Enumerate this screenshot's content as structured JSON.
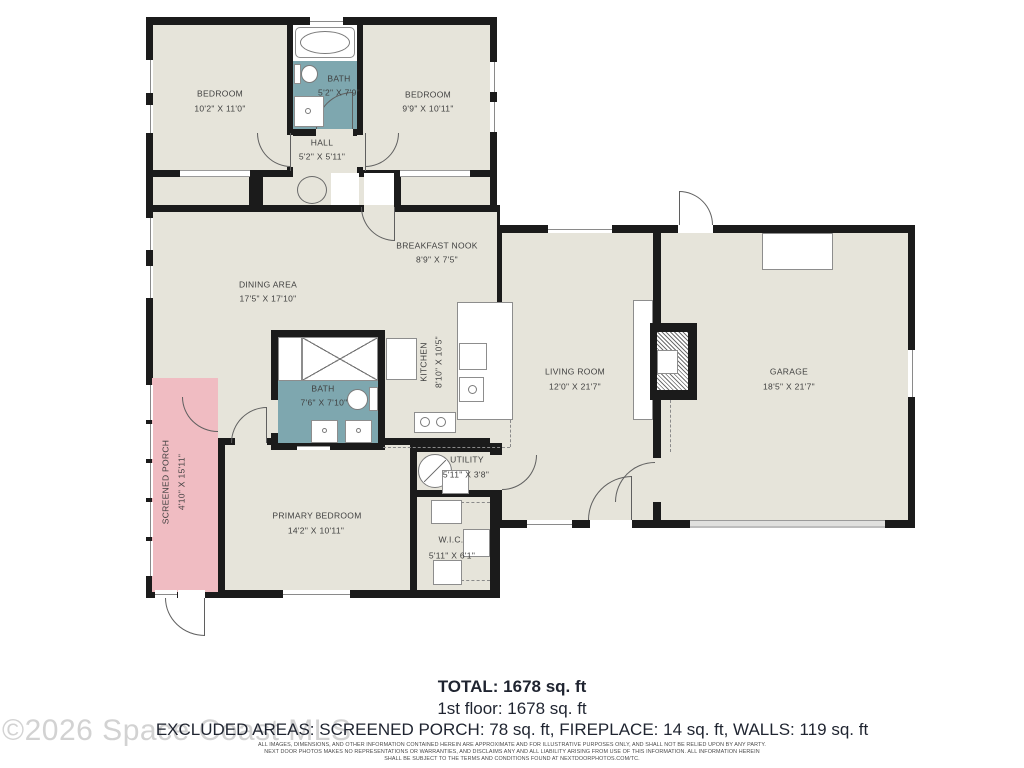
{
  "floorplan": {
    "rooms": [
      {
        "name": "BEDROOM",
        "dims": "10'2\" X 11'0\""
      },
      {
        "name": "BATH",
        "dims": "5'2\" X 7'9\""
      },
      {
        "name": "BEDROOM",
        "dims": "9'9\" X 10'11\""
      },
      {
        "name": "HALL",
        "dims": "5'2\" X 5'11\""
      },
      {
        "name": "BREAKFAST NOOK",
        "dims": "8'9\" X 7'5\""
      },
      {
        "name": "DINING AREA",
        "dims": "17'5\" X 17'10\""
      },
      {
        "name": "KITCHEN",
        "dims": "8'10\" X 10'5\""
      },
      {
        "name": "LIVING ROOM",
        "dims": "12'0\" X 21'7\""
      },
      {
        "name": "GARAGE",
        "dims": "18'5\" X 21'7\""
      },
      {
        "name": "BATH",
        "dims": "7'6\" X 7'10\""
      },
      {
        "name": "SCREENED PORCH",
        "dims": "4'10\" X 15'11\""
      },
      {
        "name": "PRIMARY BEDROOM",
        "dims": "14'2\" X 10'11\""
      },
      {
        "name": "UTILITY",
        "dims": "5'11\" X 3'8\""
      },
      {
        "name": "W.I.C.",
        "dims": "5'11\" X 6'1\""
      }
    ],
    "colors": {
      "wall": "#1b1b1b",
      "floor": "#e6e4da",
      "bath": "#7ea7af",
      "porch": "#f0bcc2"
    }
  },
  "summary": {
    "total": "TOTAL: 1678 sq. ft",
    "first_floor": "1st floor: 1678 sq. ft",
    "excluded": "EXCLUDED AREAS: SCREENED PORCH: 78 sq. ft, FIREPLACE: 14 sq. ft, WALLS: 119 sq. ft"
  },
  "disclaimer": {
    "line1": "ALL IMAGES, DIMENSIONS, AND OTHER INFORMATION CONTAINED HEREIN ARE APPROXIMATE AND FOR ILLUSTRATIVE PURPOSES ONLY, AND SHALL NOT BE RELIED UPON BY ANY PARTY.",
    "line2": "NEXT DOOR PHOTOS MAKES NO REPRESENTATIONS OR WARRANTIES, AND DISCLAIMS ANY AND ALL LIABILITY ARISING FROM USE OF THIS INFORMATION. ALL INFORMATION HEREIN",
    "line3": "SHALL BE SUBJECT TO THE TERMS AND CONDITIONS FOUND AT NEXTDOORPHOTOS.COM/TC."
  },
  "watermark": "©2026 Space Coast MLS"
}
